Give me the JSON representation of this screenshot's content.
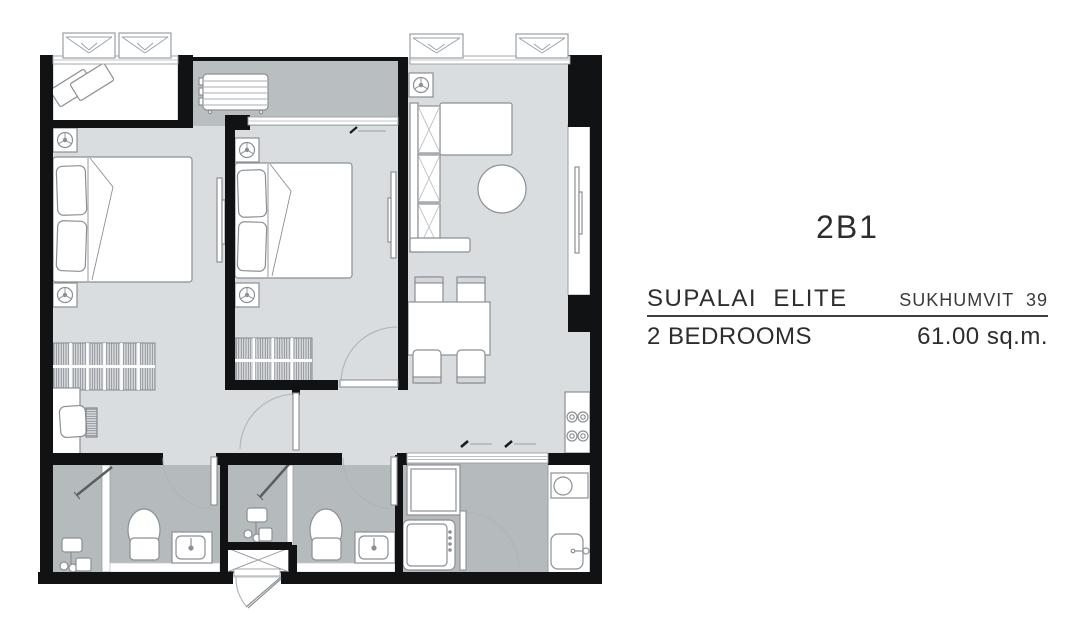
{
  "info_panel": {
    "unit_code": "2B1",
    "project_name": "SUPALAI  ELITE",
    "project_location": "SUKHUMVIT  39",
    "unit_type": "2 BEDROOMS",
    "unit_area": "61.00 sq.m."
  },
  "colors": {
    "wall": "#101214",
    "floor_light": "#d9dde0",
    "floor_dark": "#b5babd",
    "furniture_line": "#8b9095",
    "text": "#2d2d2d"
  }
}
